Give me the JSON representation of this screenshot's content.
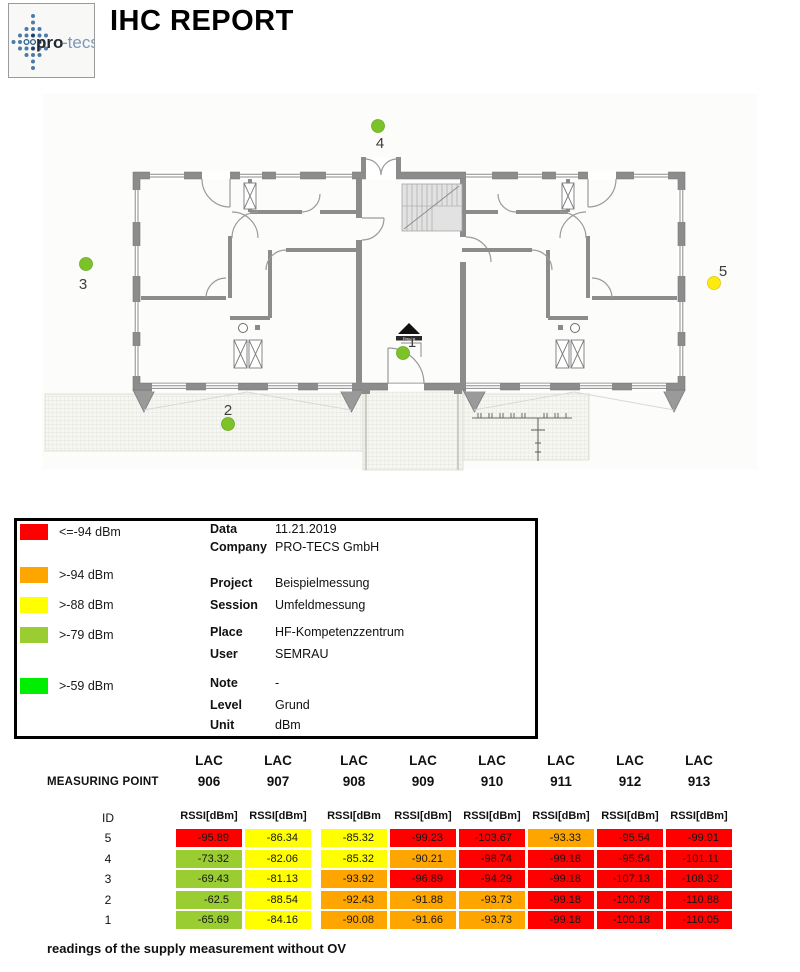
{
  "header": {
    "title": "IHC REPORT",
    "logo_text_bold": "pro",
    "logo_text_light": "-tecs"
  },
  "legend": {
    "items": [
      {
        "color": "#ff0000",
        "label": "<=-94 dBm"
      },
      {
        "color": "#ffa500",
        "label": ">-94 dBm"
      },
      {
        "color": "#ffff00",
        "label": ">-88 dBm"
      },
      {
        "color": "#9acd32",
        "label": ">-79 dBm"
      },
      {
        "color": "#00ee00",
        "label": ">-59 dBm"
      }
    ]
  },
  "info": {
    "rows": [
      {
        "label": "Data",
        "value": "11.21.2019"
      },
      {
        "label": "Company",
        "value": "PRO-TECS GmbH"
      },
      {
        "label": "Project",
        "value": "Beispielmessung"
      },
      {
        "label": "Session",
        "value": "Umfeldmessung"
      },
      {
        "label": "Place",
        "value": "HF-Kompetenzzentrum"
      },
      {
        "label": "User",
        "value": "SEMRAU"
      },
      {
        "label": "Note",
        "value": "-"
      },
      {
        "label": "Level",
        "value": "Grund"
      },
      {
        "label": "Unit",
        "value": "dBm"
      }
    ]
  },
  "plan": {
    "entrance_label": "Eingang",
    "point_colors": {
      "green": "#7cc32a",
      "yellow": "#ffe913"
    },
    "points": [
      {
        "id": "1",
        "x": 403,
        "y": 353,
        "color": "green",
        "lx": 412,
        "ly": 347
      },
      {
        "id": "2",
        "x": 228,
        "y": 424,
        "color": "green",
        "lx": 228,
        "ly": 415
      },
      {
        "id": "3",
        "x": 86,
        "y": 264,
        "color": "green",
        "lx": 83,
        "ly": 289
      },
      {
        "id": "4",
        "x": 378,
        "y": 126,
        "color": "green",
        "lx": 380,
        "ly": 148
      },
      {
        "id": "5",
        "x": 714,
        "y": 283,
        "color": "yellow",
        "lx": 723,
        "ly": 276
      }
    ]
  },
  "table": {
    "measuring_point_label": "MEASURING POINT",
    "id_label": "ID",
    "lac_label": "LAC",
    "lacs": [
      "906",
      "907",
      "908",
      "909",
      "910",
      "911",
      "912",
      "913"
    ],
    "rssi_headers": [
      "RSSI[dBm]",
      "RSSI[dBm]",
      "RSSI[dBm",
      "RSSI[dBm]",
      "RSSI[dBm]",
      "RSSI[dBm]",
      "RSSI[dBm]",
      "RSSI[dBm]"
    ],
    "cell_colors": {
      "red": "#ff0000",
      "orange": "#ffa500",
      "yellow": "#ffff00",
      "green": "#9acd32"
    },
    "rows": [
      {
        "id": "5",
        "cells": [
          [
            "-95.89",
            "red"
          ],
          [
            "-86.34",
            "yellow"
          ],
          [
            "-85.32",
            "yellow"
          ],
          [
            "-99.23",
            "red"
          ],
          [
            "-103.67",
            "red"
          ],
          [
            "-93.33",
            "orange"
          ],
          [
            "-95.54",
            "red"
          ],
          [
            "-99.91",
            "red"
          ]
        ]
      },
      {
        "id": "4",
        "cells": [
          [
            "-73.32",
            "green"
          ],
          [
            "-82.06",
            "yellow"
          ],
          [
            "-85.32",
            "yellow"
          ],
          [
            "-90.21",
            "orange"
          ],
          [
            "-98.74",
            "red"
          ],
          [
            "-99.18",
            "red"
          ],
          [
            "-95.54",
            "red"
          ],
          [
            "-101.11",
            "red"
          ]
        ]
      },
      {
        "id": "3",
        "cells": [
          [
            "-69.43",
            "green"
          ],
          [
            "-81.13",
            "yellow"
          ],
          [
            "-93.92",
            "orange"
          ],
          [
            "-96.89",
            "red"
          ],
          [
            "-94.29",
            "red"
          ],
          [
            "-99.18",
            "red"
          ],
          [
            "-107.13",
            "red"
          ],
          [
            "-108.32",
            "red"
          ]
        ]
      },
      {
        "id": "2",
        "cells": [
          [
            "-62.5",
            "green"
          ],
          [
            "-88.54",
            "yellow"
          ],
          [
            "-92.43",
            "orange"
          ],
          [
            "-91.88",
            "orange"
          ],
          [
            "-93.73",
            "orange"
          ],
          [
            "-99.18",
            "red"
          ],
          [
            "-100.78",
            "red"
          ],
          [
            "-110.88",
            "red"
          ]
        ]
      },
      {
        "id": "1",
        "cells": [
          [
            "-65.69",
            "green"
          ],
          [
            "-84.16",
            "yellow"
          ],
          [
            "-90.08",
            "orange"
          ],
          [
            "-91.66",
            "orange"
          ],
          [
            "-93.73",
            "orange"
          ],
          [
            "-99.18",
            "red"
          ],
          [
            "-100.18",
            "red"
          ],
          [
            "-110.05",
            "red"
          ]
        ]
      }
    ]
  },
  "footer": {
    "note": "readings of the supply measurement without OV"
  }
}
